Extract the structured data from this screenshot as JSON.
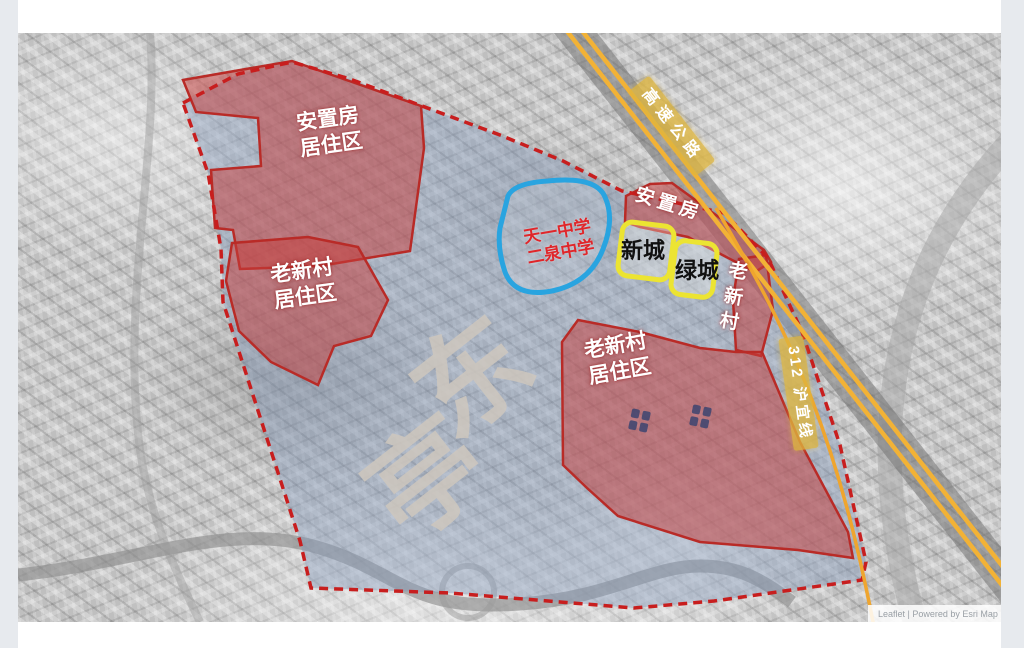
{
  "map": {
    "labels": {
      "resettlement_nw": "安置房\n居住区",
      "old_village_w": "老新村\n居住区",
      "resettlement_e": "安置房",
      "new_town": "新城",
      "green_town": "绿城",
      "old_village_strip": "老\n新\n村",
      "old_village_se": "老新村\n居住区",
      "schools": "天一中学\n二泉中学",
      "expressway": "高速公路",
      "route_312": "312 沪宜线",
      "place_watermark_char_1": "东",
      "place_watermark_char_2": "亭",
      "attribution": "Leaflet | Powered by Esri Map"
    },
    "colors": {
      "boundary_dash": "#c81e1e",
      "region_red_fill": "rgba(197,62,60,0.52)",
      "region_red_stroke": "#b92b27",
      "study_area_fill": "rgba(130,153,187,0.42)",
      "school_outline_blue": "#29a4e0",
      "town_box_yellow": "#ece432",
      "road_yellow": "#f2b236",
      "road_label_bg": "rgba(222,181,62,0.78)",
      "watermark_gray": "rgba(206,199,189,0.85)"
    }
  }
}
